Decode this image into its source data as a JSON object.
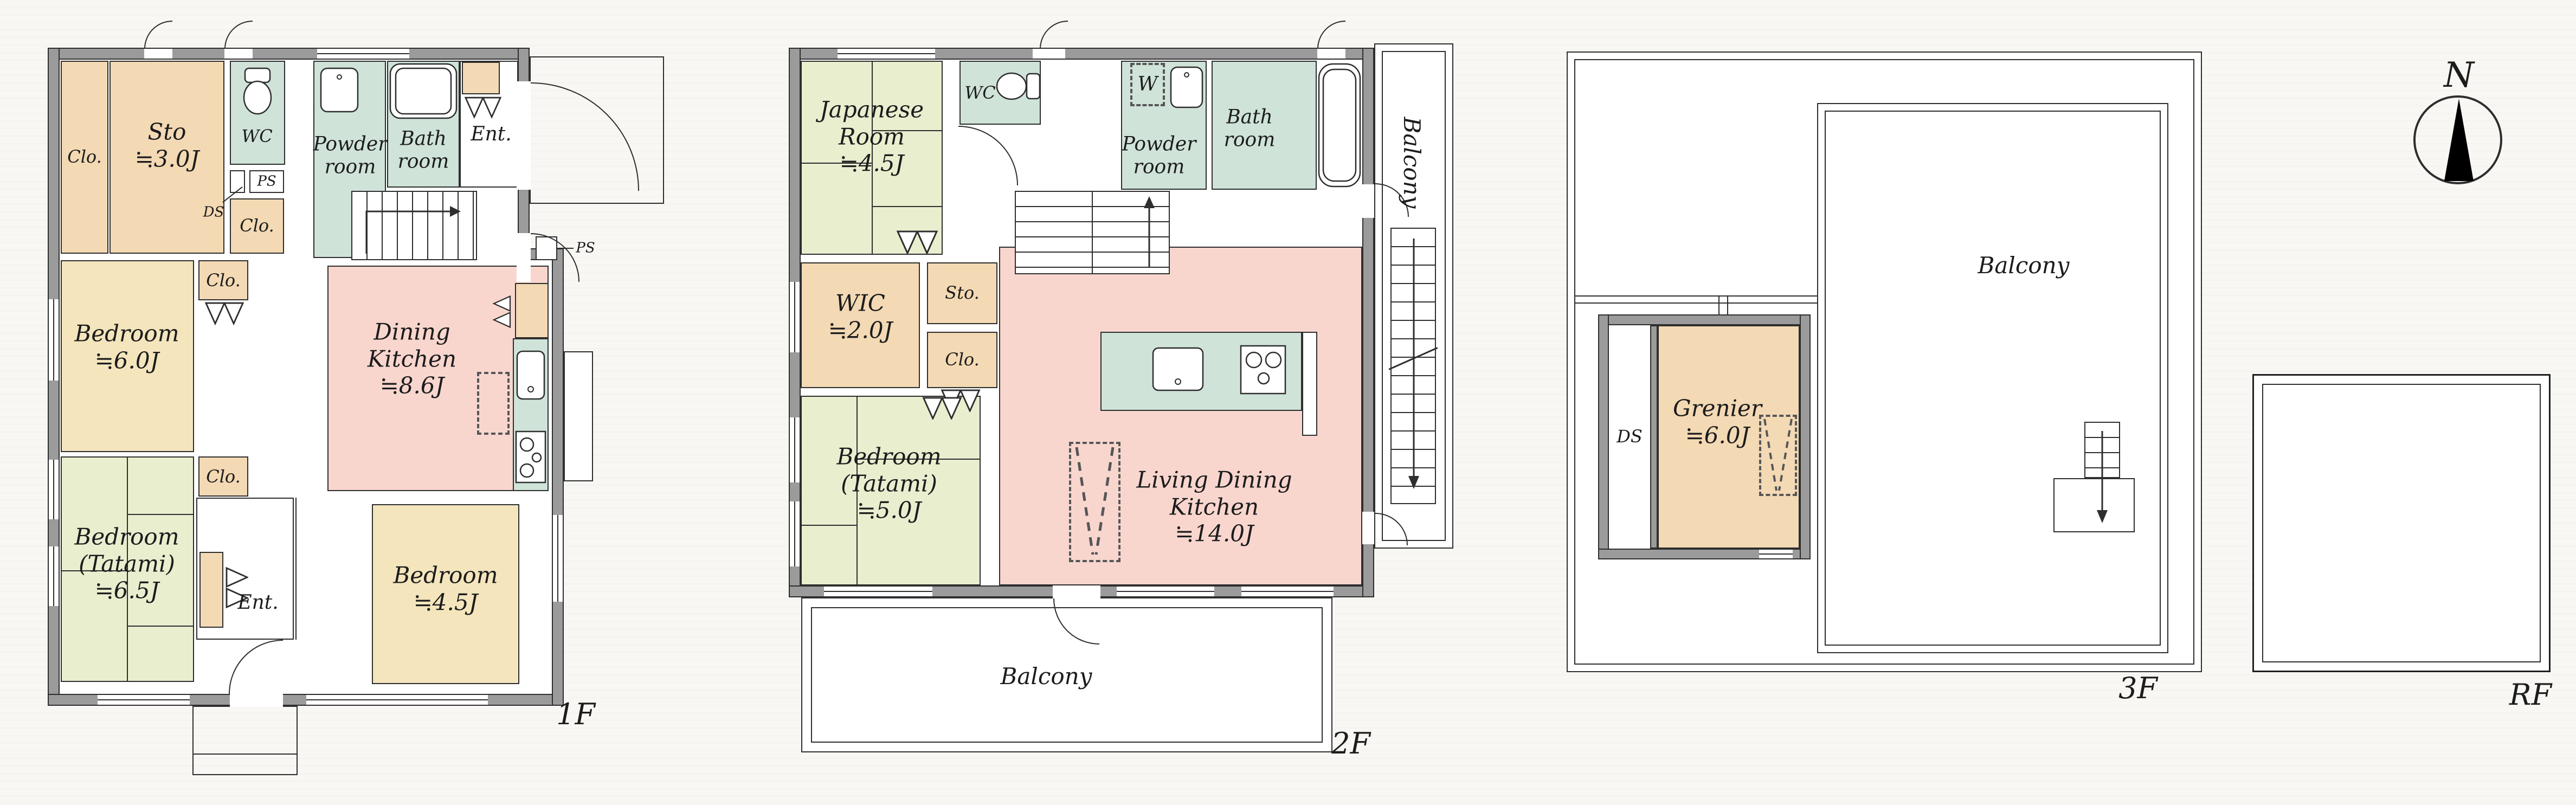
{
  "compass": {
    "north_label": "N"
  },
  "colors": {
    "wall": "#9b9b9b",
    "outline": "#2e2e2e",
    "closet_orange": "#f3d9b4",
    "bedroom_yellow": "#f4e5bd",
    "tatami_green": "#e9eecf",
    "wet_teal": "#cfe3d9",
    "ldk_pink": "#f8d6ce",
    "background": "#f7f6f3"
  },
  "floor1": {
    "floor_label": "1F",
    "rooms": {
      "clo_a": "Clo.",
      "sto": "Sto\n≒3.0J",
      "wc": "WC",
      "ds": "DS",
      "ps_a": "PS",
      "clo_b": "Clo.",
      "powder": "Powder\nroom",
      "bath": "Bath\nroom",
      "ent_top": "Ent.",
      "bedroom_6": "Bedroom\n≒6.0J",
      "clo_c": "Clo.",
      "dining_kitchen": "Dining\nKitchen\n≒8.6J",
      "ps_b": "PS",
      "bedroom_tatami": "Bedroom\n(Tatami)\n≒6.5J",
      "clo_d": "Clo.",
      "ent_bottom": "Ent.",
      "bedroom_45": "Bedroom\n≒4.5J"
    }
  },
  "floor2": {
    "floor_label": "2F",
    "rooms": {
      "japanese": "Japanese\nRoom\n≒4.5J",
      "wc": "WC",
      "w": "W",
      "powder": "Powder\nroom",
      "bath": "Bath\nroom",
      "balcony_side": "Balcony",
      "wic": "WIC\n≒2.0J",
      "sto": "Sto.",
      "clo": "Clo.",
      "ldk": "Living Dining\nKitchen\n≒14.0J",
      "bedroom_tatami": "Bedroom\n(Tatami)\n≒5.0J",
      "balcony_bottom": "Balcony"
    }
  },
  "floor3": {
    "floor_label": "3F",
    "rooms": {
      "ds": "DS",
      "grenier": "Grenier\n≒6.0J",
      "balcony": "Balcony"
    }
  },
  "roof": {
    "floor_label": "RF"
  }
}
